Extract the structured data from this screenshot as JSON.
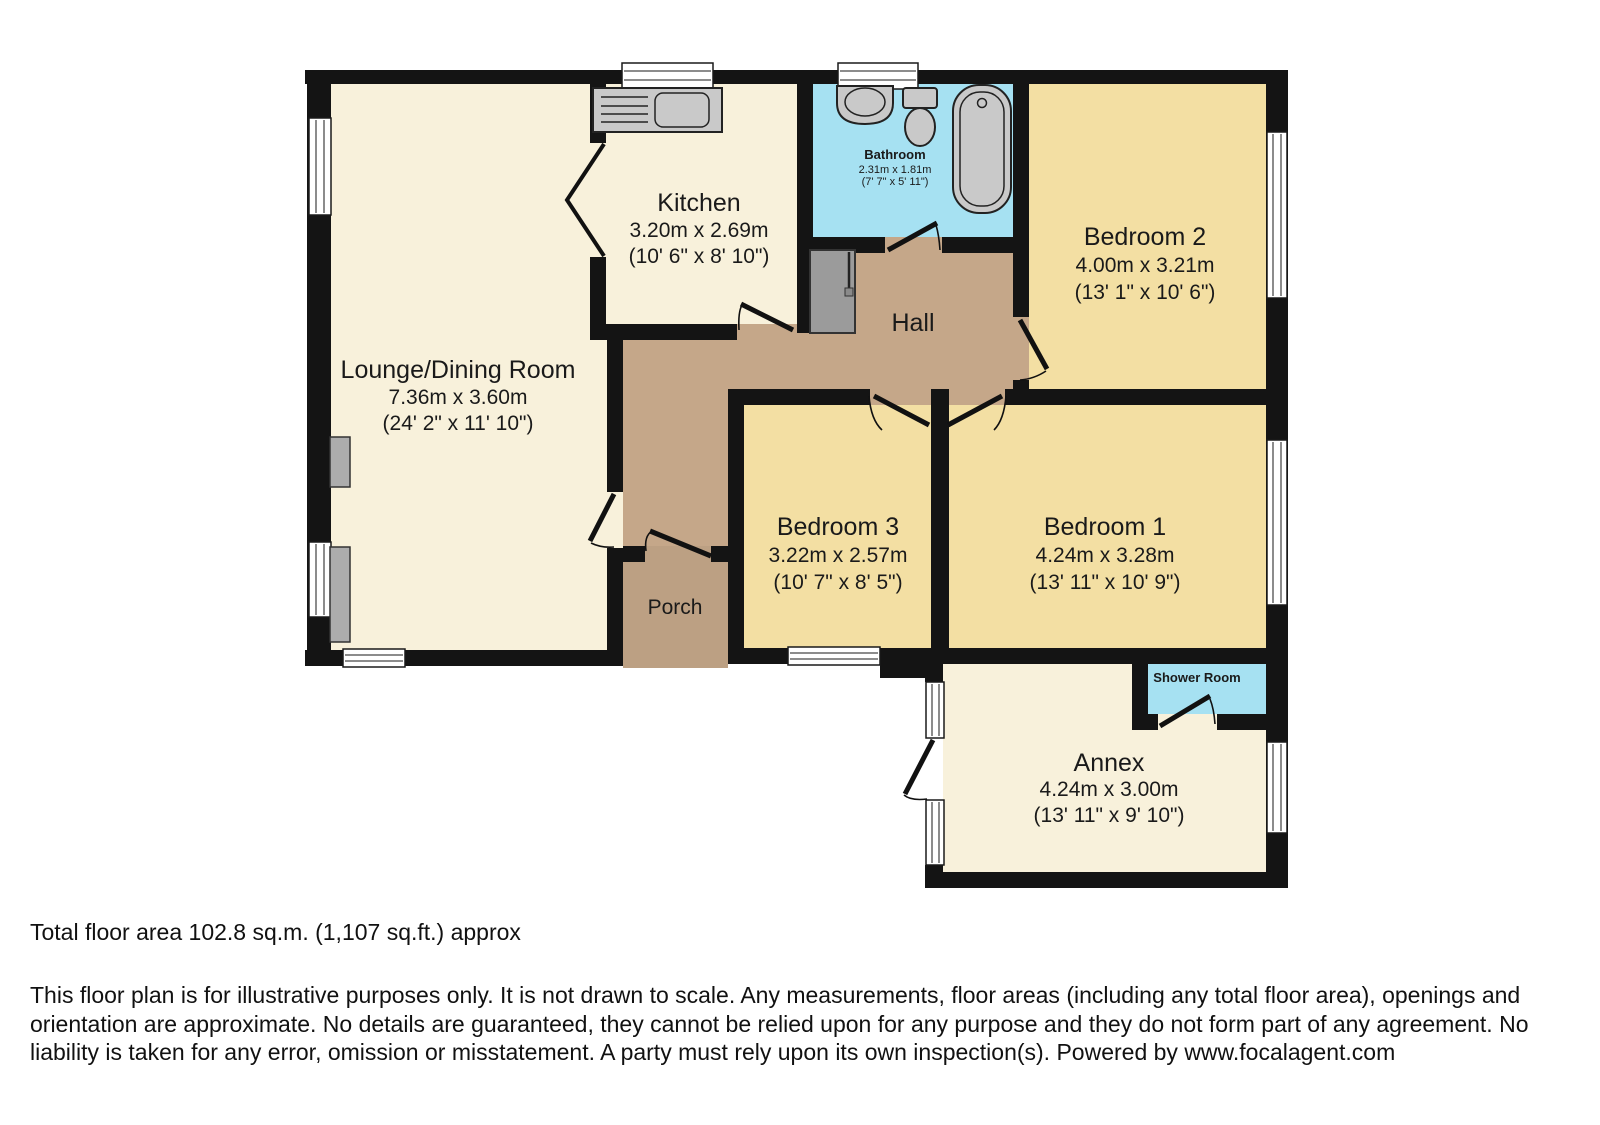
{
  "rooms": {
    "lounge": {
      "name": "Lounge/Dining Room",
      "dim_m": "7.36m x 3.60m",
      "dim_ft": "(24' 2\" x 11' 10\")"
    },
    "kitchen": {
      "name": "Kitchen",
      "dim_m": "3.20m x 2.69m",
      "dim_ft": "(10' 6\" x 8' 10\")"
    },
    "bathroom": {
      "name": "Bathroom",
      "dim_m": "2.31m x 1.81m",
      "dim_ft": "(7' 7\" x 5' 11\")"
    },
    "bedroom2": {
      "name": "Bedroom 2",
      "dim_m": "4.00m x 3.21m",
      "dim_ft": "(13' 1\" x 10' 6\")"
    },
    "hall": {
      "name": "Hall"
    },
    "bedroom3": {
      "name": "Bedroom 3",
      "dim_m": "3.22m x 2.57m",
      "dim_ft": "(10' 7\" x 8' 5\")"
    },
    "bedroom1": {
      "name": "Bedroom 1",
      "dim_m": "4.24m x 3.28m",
      "dim_ft": "(13' 11\" x 10' 9\")"
    },
    "porch": {
      "name": "Porch"
    },
    "shower": {
      "name": "Shower Room"
    },
    "annex": {
      "name": "Annex",
      "dim_m": "4.24m x 3.00m",
      "dim_ft": "(13' 11\" x 9' 10\")"
    }
  },
  "footer": {
    "total_area": "Total floor area 102.8 sq.m. (1,107 sq.ft.) approx",
    "disclaimer": "This floor plan is for illustrative purposes only. It is not drawn to scale. Any measurements, floor areas (including any total floor area), openings and orientation are approximate. No details are guaranteed, they cannot be relied upon for any purpose and they do not form part of any agreement. No liability is taken for any error, omission or misstatement. A party must rely upon its own inspection(s). Powered by www.focalagent.com"
  },
  "colors": {
    "wall": "#141414",
    "floor_cream": "#F8F1DB",
    "floor_wheat": "#F3DFA3",
    "floor_hall": "#C5A789",
    "floor_porch": "#BCA083",
    "floor_wet": "#A6E1F2",
    "fixture_gray": "#C9C9C9",
    "cupboard_gray": "#9B9B9B",
    "chimney_gray": "#ACACAC"
  }
}
